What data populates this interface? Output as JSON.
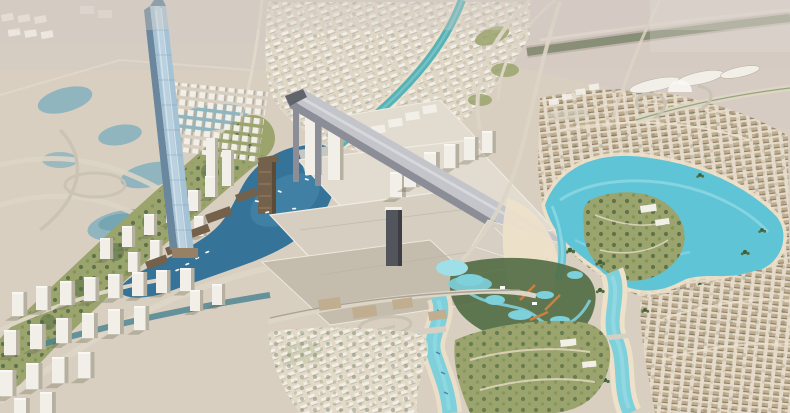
{
  "meta": {
    "type": "aerial-architectural-rendering",
    "subject": "Aerial master-plan rendering of a desert waterfront city district: supertall glass tower, mall complex with long inclined ski-slope structure, deep-blue marina with boats, turquoise crystal lagoon with park island, white high-rise clusters, beige villa communities, water park, winding canals and rivers, highway interchanges and desert lagoon pools"
  },
  "palette": {
    "haze": "#d3cac3",
    "sand": "#d8cfc0",
    "sand_light": "#e6dccb",
    "beach": "#eee2ca",
    "road_light": "#ddd5c5",
    "road_mid": "#c9c1b1",
    "pond_blue": "#8cb4bd",
    "pond_deep": "#639dab",
    "canal_teal": "#4fb0b6",
    "marina_deep": "#2c6e96",
    "marina_mid": "#4289ad",
    "lagoon": "#57c3d6",
    "lagoon_light": "#9be0e9",
    "river": "#79d0dc",
    "grass_olive": "#98a269",
    "grass_green": "#6f8d4f",
    "tree_dark": "#49663c",
    "palm_dark": "#39582f",
    "bldg_white": "#f3f1e9",
    "bldg_shade": "#b4ae9e",
    "bldg_gray": "#d5d0c3",
    "white_bright": "#fbfaf6",
    "glass_blue": "#a3c2d6",
    "glass_light": "#d9e8f1",
    "glass_edge": "#64839a",
    "bronze": "#6e5b45",
    "bronze_light": "#937d5e",
    "bronze_dark": "#55452f",
    "slope_top": "#c2c5cb",
    "slope_side": "#878b94",
    "slope_dark": "#5a5e66",
    "mall_roof": "#d5cec0",
    "mall_roof_light": "#e2dccf",
    "mall_roof_shade": "#c2bbab",
    "tower_dark": "#4b4f57",
    "tower_dark2": "#33363c",
    "orange_slide": "#cc7a3c",
    "villa_beige": "#bfab8c",
    "villa_roof": "#77684f",
    "shadow": "#55553a"
  },
  "scene": {
    "regions": [
      {
        "id": "desert-ponds",
        "label": "desert lagoon pools top-left"
      },
      {
        "id": "supertall-tower",
        "label": "slim supertall glass tower"
      },
      {
        "id": "ski-slope",
        "label": "inclined ski-slope prism over mall"
      },
      {
        "id": "mall-complex",
        "label": "mall rooftop planes"
      },
      {
        "id": "marina",
        "label": "deep blue marina basin with boats"
      },
      {
        "id": "crystal-lagoon",
        "label": "turquoise lagoon with park island"
      },
      {
        "id": "water-park",
        "label": "water park with slides"
      },
      {
        "id": "villa-communities",
        "label": "beige villa rows"
      },
      {
        "id": "white-tower-district",
        "label": "white residential high-rises"
      },
      {
        "id": "racecourse",
        "label": "grandstand canopies on horizon"
      }
    ]
  }
}
